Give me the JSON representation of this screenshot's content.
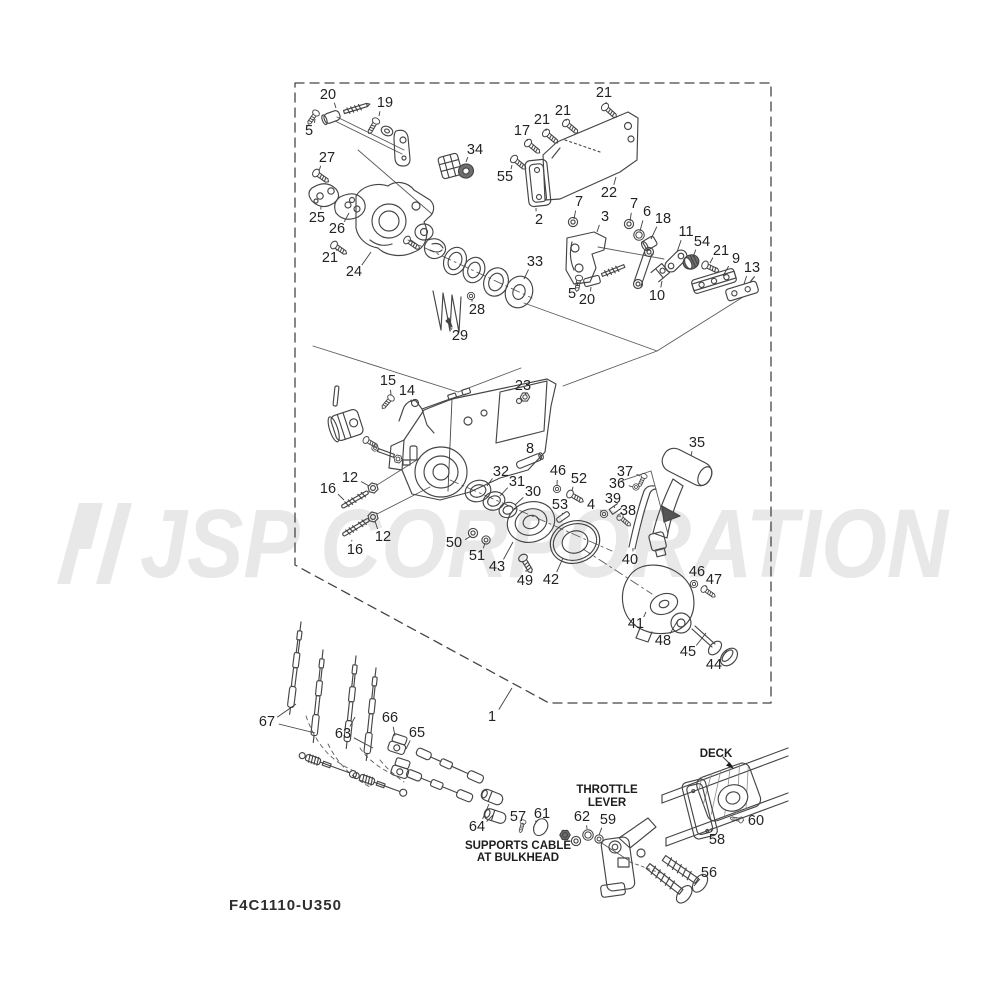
{
  "watermark": {
    "text": "JSP CORPORATION",
    "color": "#e8e8e8"
  },
  "code_label": "F4C1110-U350",
  "annotations": {
    "throttle_lever": [
      "THROTTLE",
      "LEVER"
    ],
    "supports_cable": [
      "SUPPORTS CABLE",
      "AT BULKHEAD"
    ],
    "deck": "DECK"
  },
  "colors": {
    "line": "#454545",
    "label": "#232323",
    "background": "#ffffff"
  },
  "part_labels": [
    {
      "n": "20",
      "x": 328,
      "y": 95,
      "to": [
        [
          336,
          108
        ]
      ]
    },
    {
      "n": "19",
      "x": 385,
      "y": 103,
      "to": [
        [
          379,
          116
        ]
      ]
    },
    {
      "n": "5",
      "x": 309,
      "y": 131,
      "to": [
        [
          315,
          119
        ]
      ]
    },
    {
      "n": "27",
      "x": 327,
      "y": 158,
      "to": [
        [
          319,
          171
        ]
      ]
    },
    {
      "n": "25",
      "x": 317,
      "y": 218,
      "to": [
        [
          321,
          206
        ]
      ]
    },
    {
      "n": "26",
      "x": 337,
      "y": 229,
      "to": [
        [
          349,
          213
        ]
      ]
    },
    {
      "n": "21",
      "x": 330,
      "y": 258,
      "to": [
        [
          336,
          249
        ]
      ]
    },
    {
      "n": "24",
      "x": 354,
      "y": 272,
      "to": [
        [
          371,
          252
        ]
      ]
    },
    {
      "n": "34",
      "x": 475,
      "y": 150,
      "to": [
        [
          466,
          162
        ]
      ]
    },
    {
      "n": "17",
      "x": 522,
      "y": 131,
      "to": [
        [
          527,
          141
        ]
      ]
    },
    {
      "n": "21",
      "x": 542,
      "y": 120,
      "to": [
        [
          546,
          131
        ]
      ]
    },
    {
      "n": "21",
      "x": 563,
      "y": 111,
      "to": [
        [
          566,
          121
        ]
      ]
    },
    {
      "n": "21",
      "x": 604,
      "y": 93,
      "to": [
        [
          606,
          104
        ]
      ]
    },
    {
      "n": "55",
      "x": 505,
      "y": 177,
      "to": [
        [
          512,
          165
        ]
      ]
    },
    {
      "n": "22",
      "x": 609,
      "y": 193,
      "to": [
        [
          616,
          177
        ]
      ]
    },
    {
      "n": "2",
      "x": 539,
      "y": 220,
      "to": [
        [
          536,
          208
        ]
      ]
    },
    {
      "n": "7",
      "x": 579,
      "y": 202,
      "to": [
        [
          574,
          219
        ]
      ]
    },
    {
      "n": "3",
      "x": 605,
      "y": 217,
      "to": [
        [
          597,
          232
        ]
      ]
    },
    {
      "n": "7",
      "x": 634,
      "y": 204,
      "to": [
        [
          630,
          221
        ]
      ]
    },
    {
      "n": "6",
      "x": 647,
      "y": 212,
      "to": [
        [
          640,
          231
        ]
      ]
    },
    {
      "n": "18",
      "x": 663,
      "y": 219,
      "to": [
        [
          651,
          239
        ]
      ]
    },
    {
      "n": "11",
      "x": 686,
      "y": 232,
      "to": [
        [
          677,
          252
        ]
      ]
    },
    {
      "n": "54",
      "x": 702,
      "y": 242,
      "to": [
        [
          693,
          257
        ]
      ]
    },
    {
      "n": "21",
      "x": 721,
      "y": 251,
      "to": [
        [
          710,
          263
        ]
      ]
    },
    {
      "n": "9",
      "x": 736,
      "y": 259,
      "to": [
        [
          723,
          276
        ]
      ]
    },
    {
      "n": "13",
      "x": 752,
      "y": 268,
      "to": [
        [
          744,
          284
        ]
      ]
    },
    {
      "n": "33",
      "x": 535,
      "y": 262,
      "to": [
        [
          524,
          279
        ]
      ]
    },
    {
      "n": "28",
      "x": 477,
      "y": 310,
      "to": [
        [
          472,
          299
        ]
      ]
    },
    {
      "n": "29",
      "x": 460,
      "y": 336,
      "to": [
        [
          452,
          328
        ]
      ]
    },
    {
      "n": "5",
      "x": 572,
      "y": 294,
      "to": [
        [
          578,
          282
        ]
      ]
    },
    {
      "n": "20",
      "x": 587,
      "y": 300,
      "to": [
        [
          591,
          287
        ]
      ]
    },
    {
      "n": "10",
      "x": 657,
      "y": 296,
      "to": [
        [
          662,
          281
        ]
      ]
    },
    {
      "n": "15",
      "x": 388,
      "y": 381,
      "to": [
        [
          391,
          395
        ]
      ]
    },
    {
      "n": "14",
      "x": 407,
      "y": 391,
      "to": [
        [
          411,
          402
        ]
      ]
    },
    {
      "n": "23",
      "x": 523,
      "y": 386,
      "to": [
        [
          525,
          393
        ]
      ]
    },
    {
      "n": "8",
      "x": 530,
      "y": 449,
      "to": [
        [
          529,
          457
        ]
      ]
    },
    {
      "n": "32",
      "x": 501,
      "y": 472,
      "to": [
        [
          487,
          486
        ]
      ]
    },
    {
      "n": "31",
      "x": 517,
      "y": 482,
      "to": [
        [
          500,
          496
        ]
      ]
    },
    {
      "n": "30",
      "x": 533,
      "y": 492,
      "to": [
        [
          515,
          505
        ]
      ]
    },
    {
      "n": "12",
      "x": 350,
      "y": 478,
      "to": [
        [
          369,
          486
        ]
      ]
    },
    {
      "n": "16",
      "x": 328,
      "y": 489,
      "to": [
        [
          344,
          500
        ]
      ]
    },
    {
      "n": "12",
      "x": 383,
      "y": 537,
      "to": [
        [
          375,
          521
        ]
      ]
    },
    {
      "n": "16",
      "x": 355,
      "y": 550,
      "to": [
        [
          352,
          540
        ]
      ]
    },
    {
      "n": "46",
      "x": 558,
      "y": 471,
      "to": [
        [
          557,
          486
        ]
      ]
    },
    {
      "n": "52",
      "x": 579,
      "y": 479,
      "to": [
        [
          572,
          491
        ]
      ]
    },
    {
      "n": "53",
      "x": 560,
      "y": 505,
      "to": [
        [
          562,
          513
        ]
      ]
    },
    {
      "n": "37",
      "x": 625,
      "y": 472,
      "to": [
        [
          640,
          476
        ]
      ]
    },
    {
      "n": "36",
      "x": 617,
      "y": 484,
      "to": [
        [
          633,
          487
        ]
      ]
    },
    {
      "n": "39",
      "x": 613,
      "y": 499,
      "to": [
        [
          614,
          506
        ]
      ]
    },
    {
      "n": "4",
      "x": 591,
      "y": 505,
      "to": [
        [
          601,
          512
        ]
      ]
    },
    {
      "n": "38",
      "x": 628,
      "y": 511,
      "to": [
        [
          621,
          516
        ]
      ]
    },
    {
      "n": "35",
      "x": 697,
      "y": 443,
      "to": [
        [
          691,
          456
        ]
      ]
    },
    {
      "n": "50",
      "x": 454,
      "y": 543,
      "to": [
        [
          471,
          536
        ]
      ]
    },
    {
      "n": "51",
      "x": 477,
      "y": 556,
      "to": [
        [
          485,
          543
        ]
      ]
    },
    {
      "n": "43",
      "x": 497,
      "y": 567,
      "to": [
        [
          513,
          542
        ]
      ]
    },
    {
      "n": "49",
      "x": 525,
      "y": 581,
      "to": [
        [
          526,
          570
        ]
      ]
    },
    {
      "n": "42",
      "x": 551,
      "y": 580,
      "to": [
        [
          563,
          558
        ]
      ]
    },
    {
      "n": "40",
      "x": 630,
      "y": 560,
      "to": [
        [
          633,
          548
        ]
      ]
    },
    {
      "n": "41",
      "x": 636,
      "y": 624,
      "to": [
        [
          646,
          612
        ]
      ]
    },
    {
      "n": "46",
      "x": 697,
      "y": 572,
      "to": [
        [
          695,
          581
        ]
      ]
    },
    {
      "n": "47",
      "x": 714,
      "y": 580,
      "to": [
        [
          707,
          587
        ]
      ]
    },
    {
      "n": "48",
      "x": 663,
      "y": 641,
      "to": [
        [
          678,
          620
        ]
      ]
    },
    {
      "n": "45",
      "x": 688,
      "y": 652,
      "to": [
        [
          706,
          633
        ]
      ]
    },
    {
      "n": "44",
      "x": 714,
      "y": 665,
      "to": [
        [
          727,
          650
        ]
      ]
    },
    {
      "n": "67",
      "x": 267,
      "y": 722,
      "to": [
        [
          296,
          704
        ],
        [
          315,
          733
        ]
      ]
    },
    {
      "n": "63",
      "x": 343,
      "y": 734,
      "to": [
        [
          355,
          717
        ],
        [
          373,
          748
        ]
      ]
    },
    {
      "n": "66",
      "x": 390,
      "y": 718,
      "to": [
        [
          395,
          736
        ]
      ]
    },
    {
      "n": "65",
      "x": 417,
      "y": 733,
      "to": [
        [
          406,
          749
        ]
      ]
    },
    {
      "n": "1",
      "x": 492,
      "y": 717,
      "to": [
        [
          512,
          688
        ]
      ]
    },
    {
      "n": "64",
      "x": 477,
      "y": 827,
      "to": [
        [
          489,
          804
        ],
        [
          493,
          815
        ]
      ]
    },
    {
      "n": "57",
      "x": 518,
      "y": 817,
      "to": [
        [
          522,
          823
        ]
      ]
    },
    {
      "n": "61",
      "x": 542,
      "y": 814,
      "to": [
        [
          537,
          821
        ]
      ]
    },
    {
      "n": "62",
      "x": 582,
      "y": 817,
      "to": [
        [
          587,
          829
        ]
      ]
    },
    {
      "n": "59",
      "x": 608,
      "y": 820,
      "to": [
        [
          599,
          835
        ]
      ]
    },
    {
      "n": "60",
      "x": 756,
      "y": 821,
      "to": [
        [
          743,
          820
        ]
      ]
    },
    {
      "n": "58",
      "x": 717,
      "y": 840,
      "to": [
        [
          711,
          828
        ]
      ]
    },
    {
      "n": "56",
      "x": 709,
      "y": 873,
      "to": [
        [
          694,
          886
        ]
      ]
    }
  ]
}
